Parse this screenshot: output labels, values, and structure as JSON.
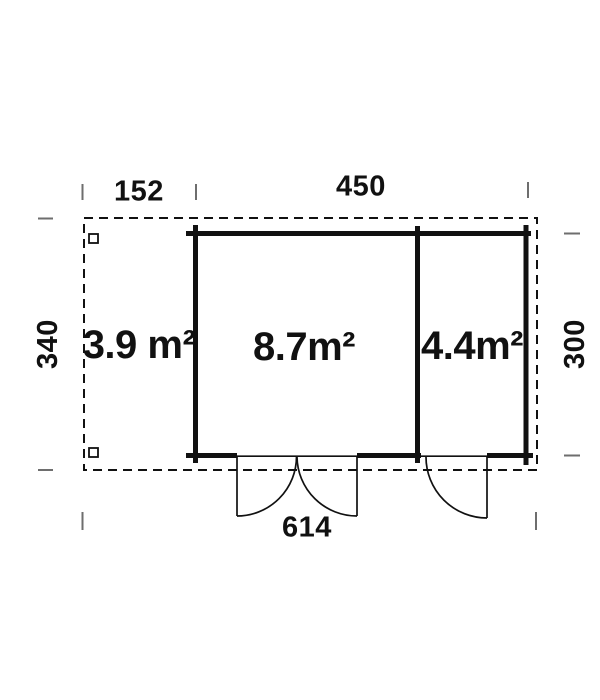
{
  "plan": {
    "dimensions": {
      "canopy_width": "152",
      "cabin_width": "450",
      "left_depth": "340",
      "right_depth": "300",
      "total_width": "614"
    },
    "areas": {
      "canopy": "3.9 m²",
      "main_room": "8.7m²",
      "side_room": "4.4m²"
    },
    "colors": {
      "line": "#111111",
      "tick": "#6e6e6e",
      "text": "#111111",
      "background": "#ffffff"
    }
  }
}
